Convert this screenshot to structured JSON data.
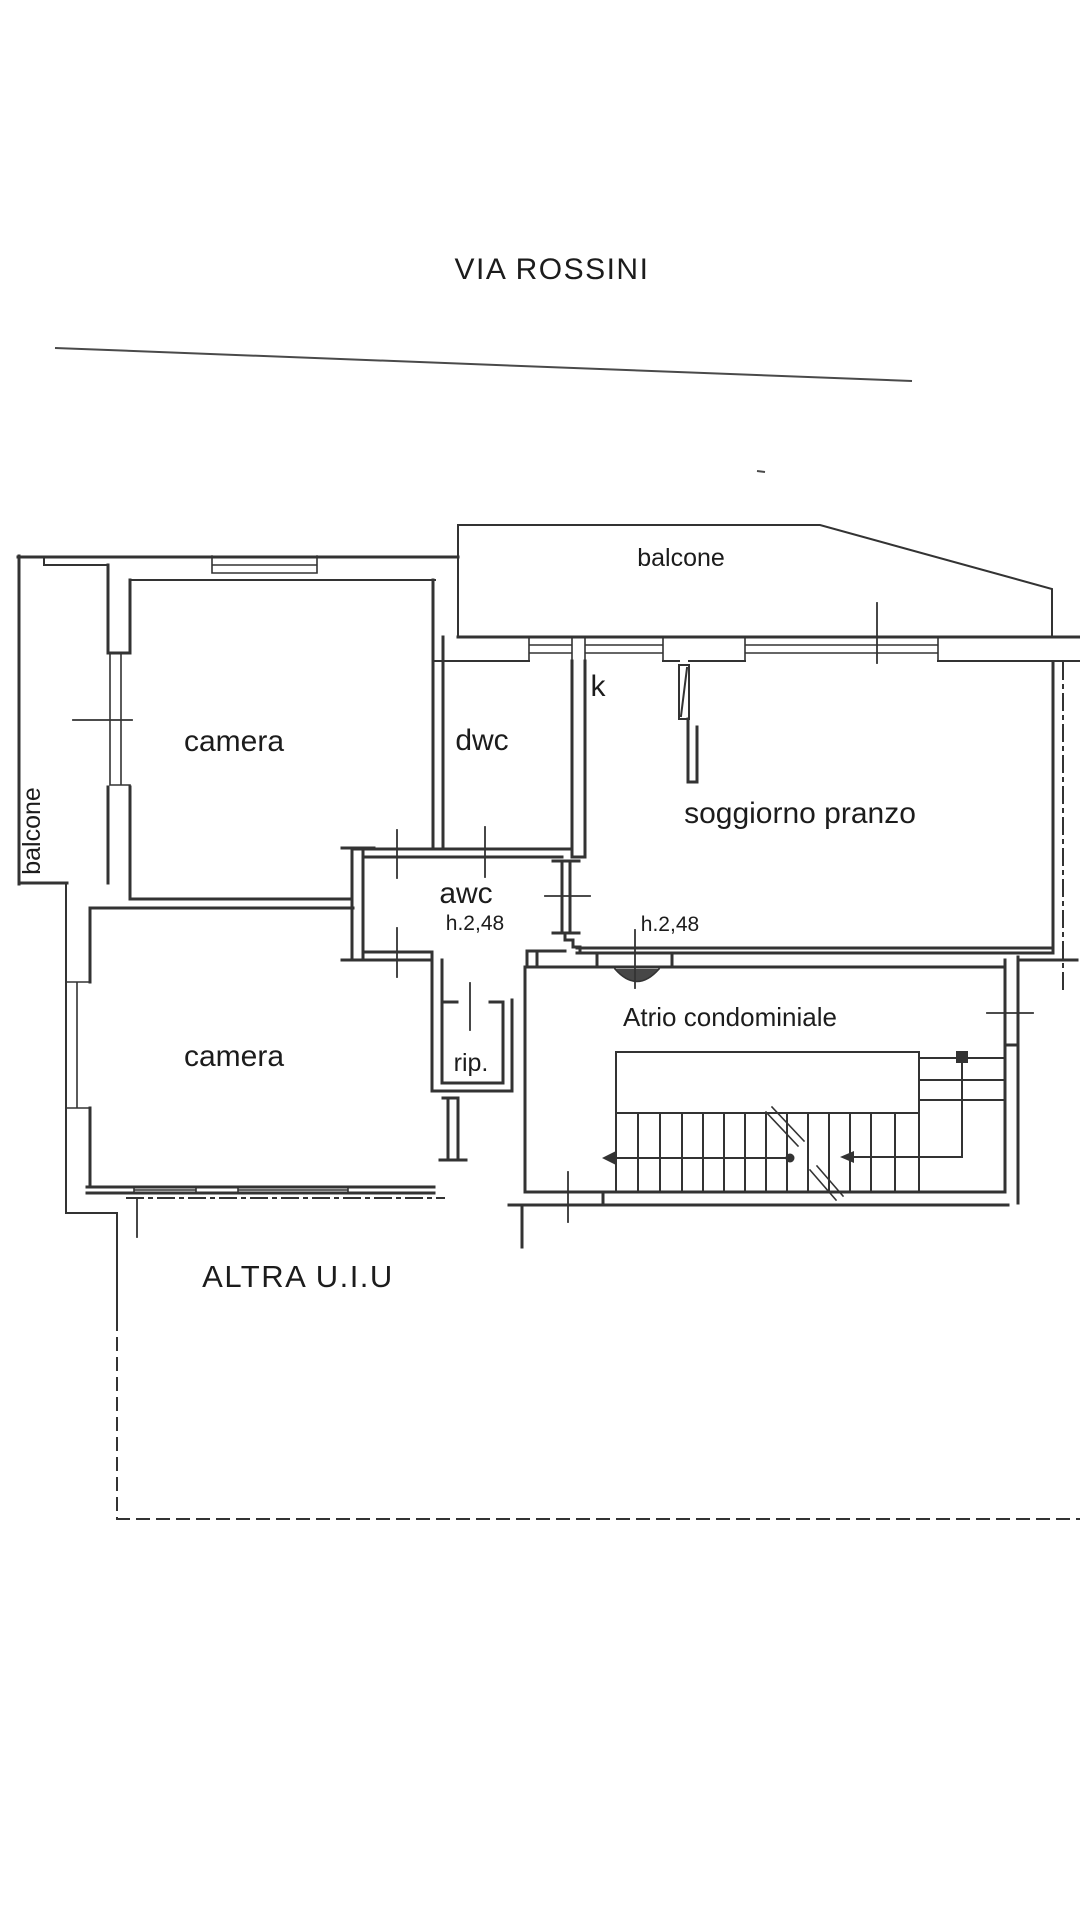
{
  "title": "VIA ROSSINI",
  "colors": {
    "line": "#333333",
    "street": "#4a4a4a",
    "background": "#ffffff",
    "text": "#1c1c1c"
  },
  "labels": {
    "street_name": "VIA ROSSINI",
    "balcony_top": "balcone",
    "balcony_left": "balcone",
    "bedroom_top": "camera",
    "bedroom_bottom": "camera",
    "dwc": "dwc",
    "kitchen": "k",
    "living_room": "soggiorno pranzo",
    "awc": "awc",
    "height_note_a": "h.2,48",
    "height_note_b": "h.2,48",
    "storage": "rip.",
    "atrium": "Atrio condominiale",
    "other_unit": "ALTRA U.I.U"
  }
}
